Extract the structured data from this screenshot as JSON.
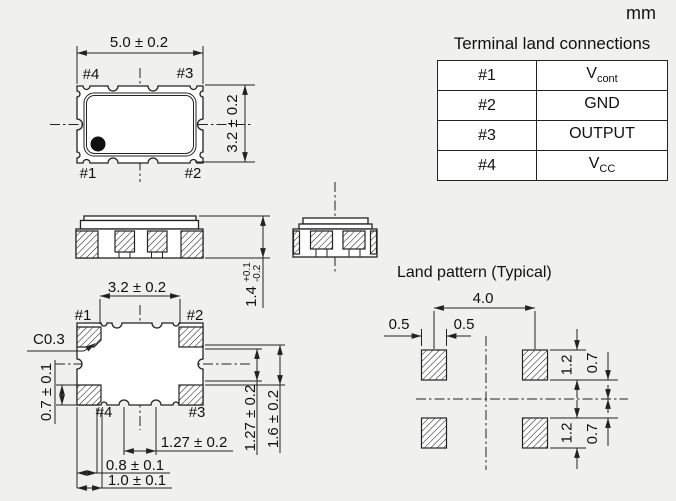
{
  "units_label": "mm",
  "terminal_table": {
    "title": "Terminal land connections",
    "rows": [
      {
        "pin": "#1",
        "signal": "V",
        "signal_sub": "cont"
      },
      {
        "pin": "#2",
        "signal": "GND",
        "signal_sub": ""
      },
      {
        "pin": "#3",
        "signal": "OUTPUT",
        "signal_sub": ""
      },
      {
        "pin": "#4",
        "signal": "V",
        "signal_sub": "CC"
      }
    ]
  },
  "top_view": {
    "width_dim": "5.0 ± 0.2",
    "height_dim": "3.2 ± 0.2",
    "pin_top_left": "#4",
    "pin_top_right": "#3",
    "pin_bottom_left": "#1",
    "pin_bottom_right": "#2"
  },
  "side_view": {
    "height_dim_value": "1.4",
    "height_dim_tol_plus": "+0.1",
    "height_dim_tol_minus": "-0.2"
  },
  "bottom_view": {
    "top_dim": "3.2 ± 0.2",
    "chamfer_dim": "C0.3",
    "pad_height_dim": "0.7 ± 0.1",
    "pad_pitch_dim": "1.27 ± 0.2",
    "pad_width_dim_1": "0.8 ± 0.1",
    "pad_width_dim_2": "1.0 ± 0.1",
    "right_pitch_dim": "1.27 ± 0.2",
    "right_span_dim": "1.6 ± 0.2",
    "pin_top_left": "#1",
    "pin_top_right": "#2",
    "pin_bottom_left": "#4",
    "pin_bottom_right": "#3"
  },
  "land_pattern": {
    "title": "Land pattern (Typical)",
    "pitch_dim": "4.0",
    "half_width_left": "0.5",
    "half_width_right": "0.5",
    "pad_height_top": "1.2",
    "gap_top": "0.7",
    "pad_height_bottom": "1.2",
    "gap_bottom": "0.7"
  },
  "colors": {
    "background": "#f0f0ee",
    "line": "#222222",
    "panel": "#ffffff"
  }
}
